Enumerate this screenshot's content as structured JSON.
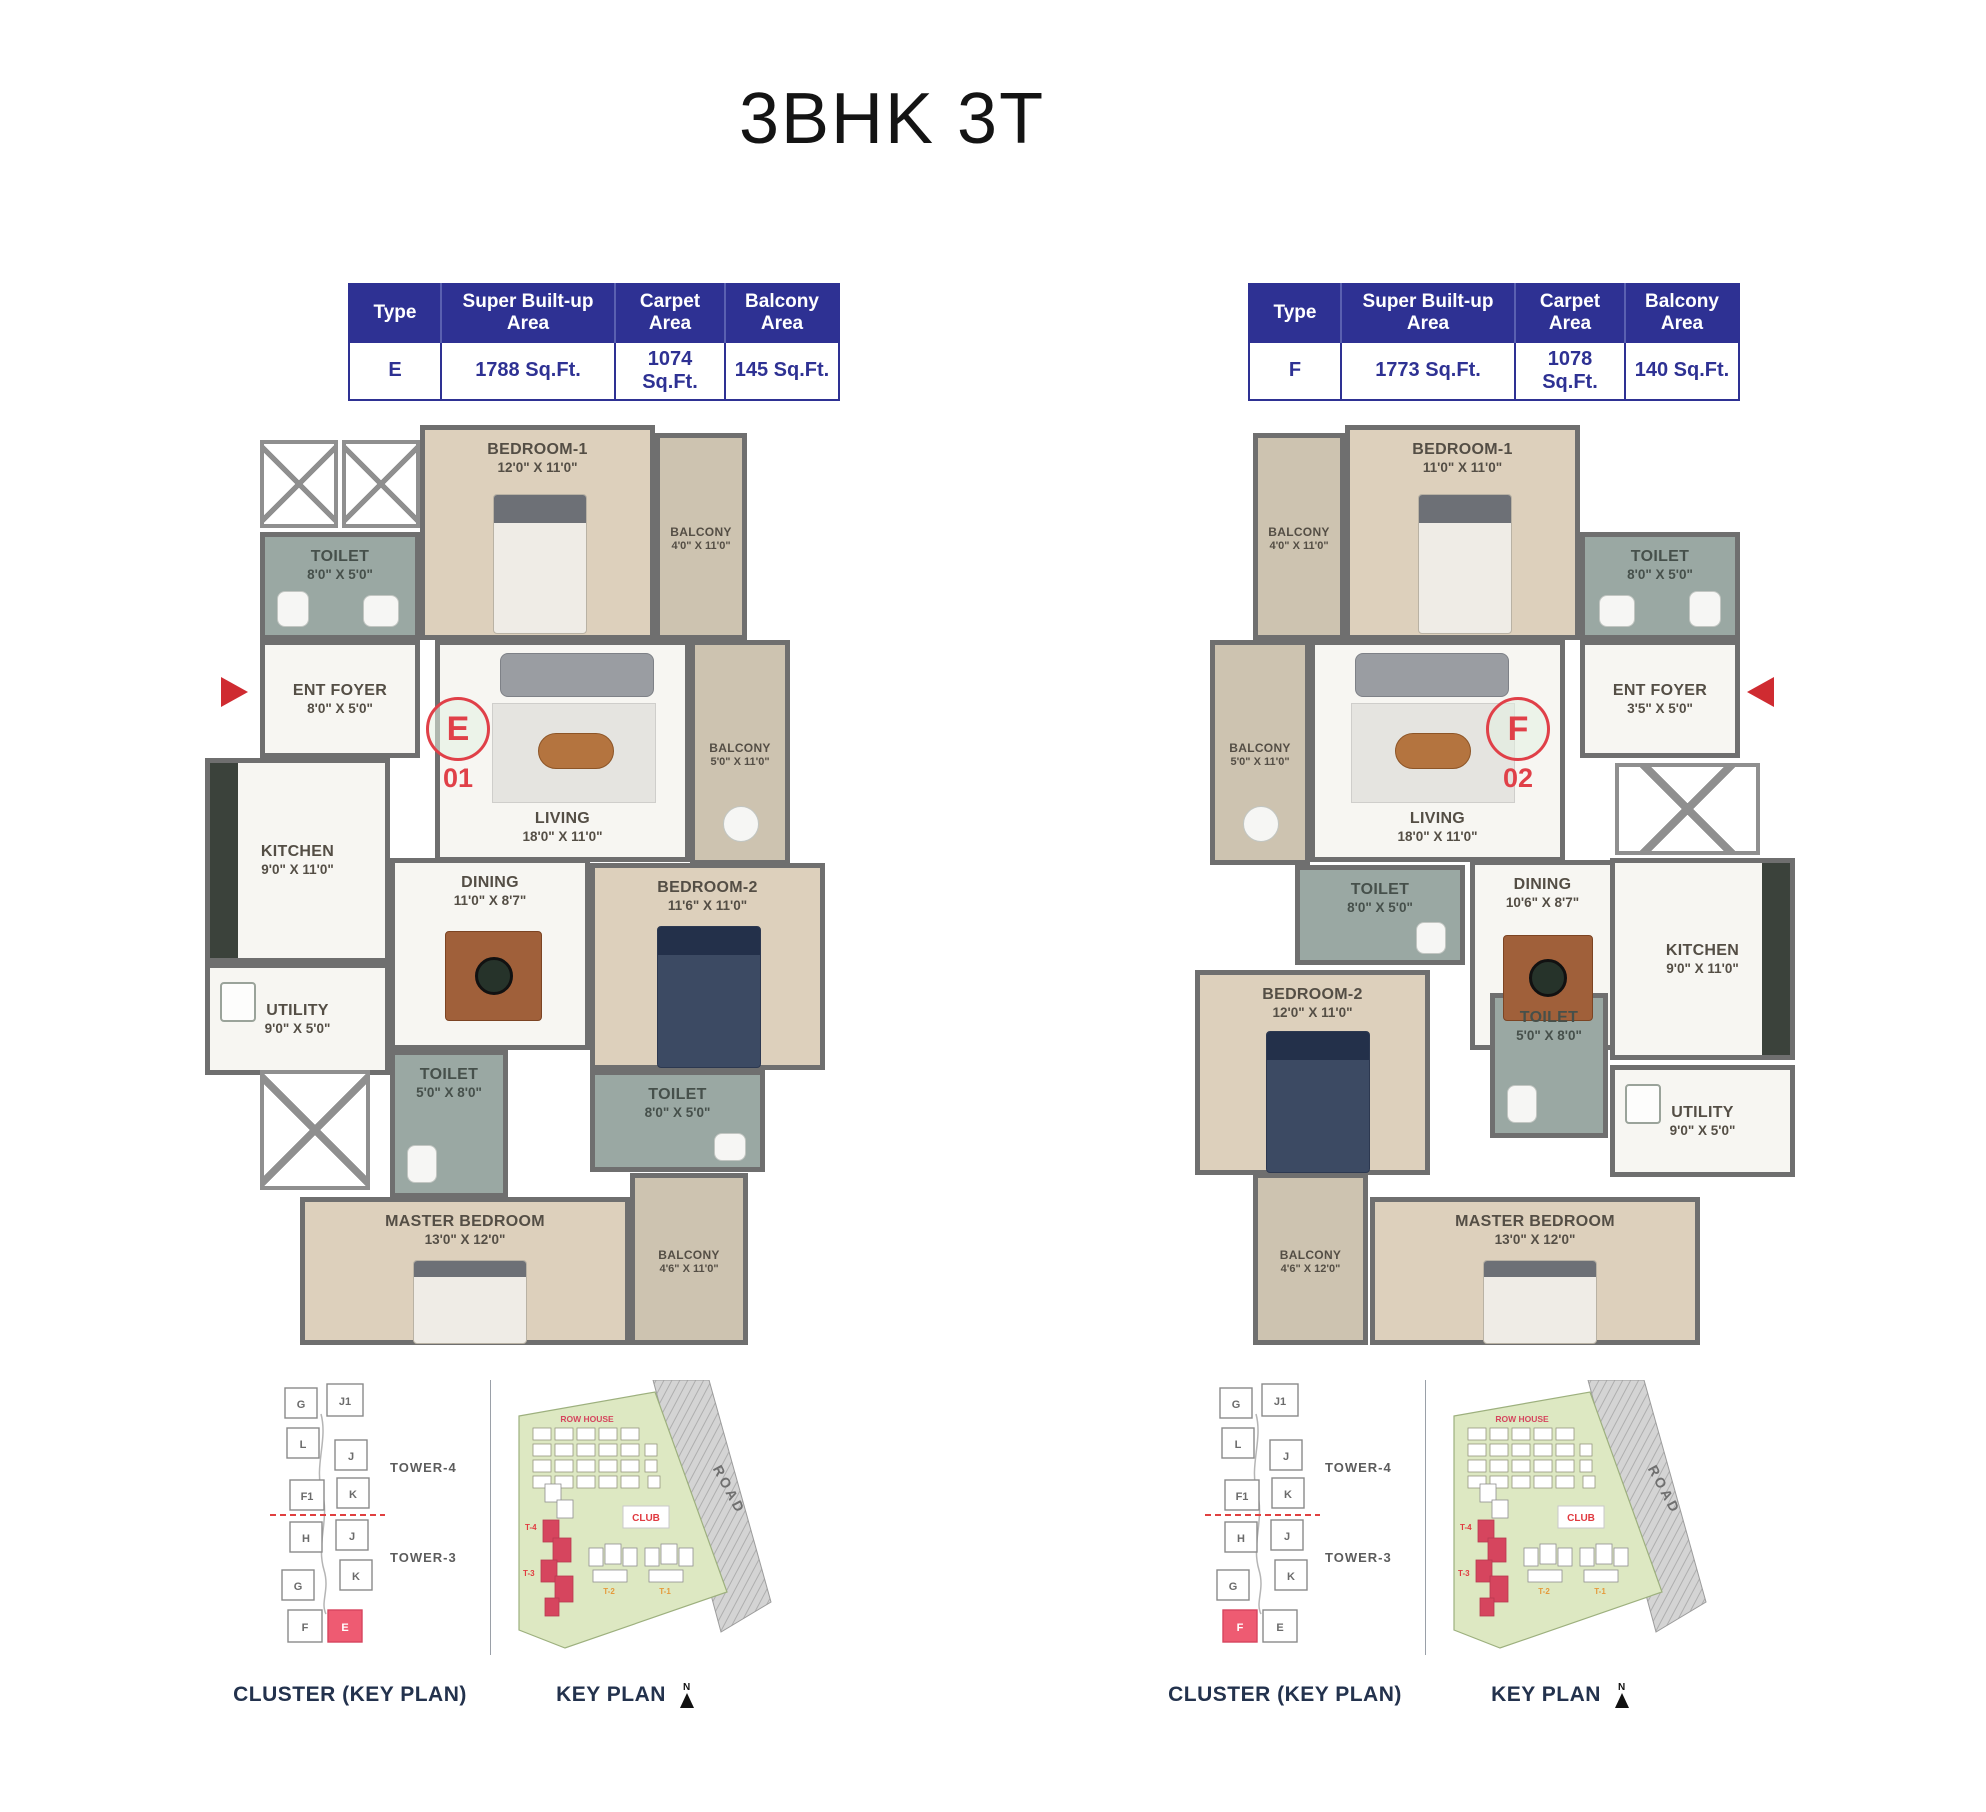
{
  "title": "3BHK 3T",
  "table": {
    "headers": [
      "Type",
      "Super Built-up Area",
      "Carpet Area",
      "Balcony Area"
    ]
  },
  "units": [
    {
      "type": "E",
      "unit_number": "01",
      "super_built_up_area": "1788 Sq.Ft.",
      "carpet_area": "1074 Sq.Ft.",
      "balcony_area": "145 Sq.Ft.",
      "rooms": {
        "bedroom1": {
          "name": "BEDROOM-1",
          "dims": "12'0\" X 11'0\""
        },
        "balcony_top": {
          "name": "BALCONY",
          "dims": "4'0\" X 11'0\""
        },
        "toilet_top": {
          "name": "TOILET",
          "dims": "8'0\" X 5'0\""
        },
        "ent_foyer": {
          "name": "ENT FOYER",
          "dims": "8'0\" X 5'0\""
        },
        "living": {
          "name": "LIVING",
          "dims": "18'0\" X 11'0\""
        },
        "balcony_living": {
          "name": "BALCONY",
          "dims": "5'0\" X 11'0\""
        },
        "kitchen": {
          "name": "KITCHEN",
          "dims": "9'0\" X 11'0\""
        },
        "utility": {
          "name": "UTILITY",
          "dims": "9'0\" X 5'0\""
        },
        "dining": {
          "name": "DINING",
          "dims": "11'0\" X 8'7\""
        },
        "bedroom2": {
          "name": "BEDROOM-2",
          "dims": "11'6\" X 11'0\""
        },
        "toilet_mid": {
          "name": "TOILET",
          "dims": "5'0\" X 8'0\""
        },
        "toilet_bed2": {
          "name": "TOILET",
          "dims": "8'0\" X 5'0\""
        },
        "master_bedroom": {
          "name": "MASTER BEDROOM",
          "dims": "13'0\" X 12'0\""
        },
        "balcony_master": {
          "name": "BALCONY",
          "dims": "4'6\" X 11'0\""
        }
      }
    },
    {
      "type": "F",
      "unit_number": "02",
      "super_built_up_area": "1773 Sq.Ft.",
      "carpet_area": "1078 Sq.Ft.",
      "balcony_area": "140 Sq.Ft.",
      "rooms": {
        "bedroom1": {
          "name": "BEDROOM-1",
          "dims": "11'0\" X 11'0\""
        },
        "balcony_top": {
          "name": "BALCONY",
          "dims": "4'0\" X 11'0\""
        },
        "toilet_top": {
          "name": "TOILET",
          "dims": "8'0\" X 5'0\""
        },
        "ent_foyer": {
          "name": "ENT FOYER",
          "dims": "3'5\" X 5'0\""
        },
        "living": {
          "name": "LIVING",
          "dims": "18'0\" X 11'0\""
        },
        "balcony_living": {
          "name": "BALCONY",
          "dims": "5'0\" X 11'0\""
        },
        "kitchen": {
          "name": "KITCHEN",
          "dims": "9'0\" X 11'0\""
        },
        "utility": {
          "name": "UTILITY",
          "dims": "9'0\" X 5'0\""
        },
        "dining": {
          "name": "DINING",
          "dims": "10'6\" X 8'7\""
        },
        "bedroom2": {
          "name": "BEDROOM-2",
          "dims": "12'0\" X 11'0\""
        },
        "toilet_mid": {
          "name": "TOILET",
          "dims": "8'0\" X 5'0\""
        },
        "toilet_bed2": {
          "name": "TOILET",
          "dims": "5'0\" X 8'0\""
        },
        "master_bedroom": {
          "name": "MASTER BEDROOM",
          "dims": "13'0\" X 12'0\""
        },
        "balcony_master": {
          "name": "BALCONY",
          "dims": "4'6\" X 12'0\""
        }
      }
    }
  ],
  "key_plans": {
    "cluster_caption": "CLUSTER (KEY PLAN)",
    "key_caption": "KEY PLAN",
    "north_label": "N",
    "tower4_label": "TOWER-4",
    "tower3_label": "TOWER-3",
    "cluster_units": [
      "G",
      "J1",
      "L",
      "J",
      "F1",
      "K",
      "H",
      "J",
      "K",
      "G",
      "F",
      "E"
    ],
    "site": {
      "row_house_label": "ROW HOUSE",
      "club_label": "CLUB",
      "road_label": "ROAD",
      "tower_t4": "T-4",
      "tower_t3": "T-3",
      "tower_t2": "T-2",
      "tower_t1": "T-1"
    }
  },
  "colors": {
    "table_navy": "#2e3193",
    "unit_red": "#e04048",
    "entry_arrow_red": "#cf2b31",
    "highlight_pink": "#ee5b72",
    "wall_gray": "#6f6f6f",
    "floor_tan": "#ddd0bc",
    "floor_toilet_green": "#9aa8a3",
    "floor_balcony_taupe": "#cdc3b0",
    "site_green": "#dde8c2",
    "road_gray": "#cfcfcf",
    "caption_navy": "#23324d"
  }
}
